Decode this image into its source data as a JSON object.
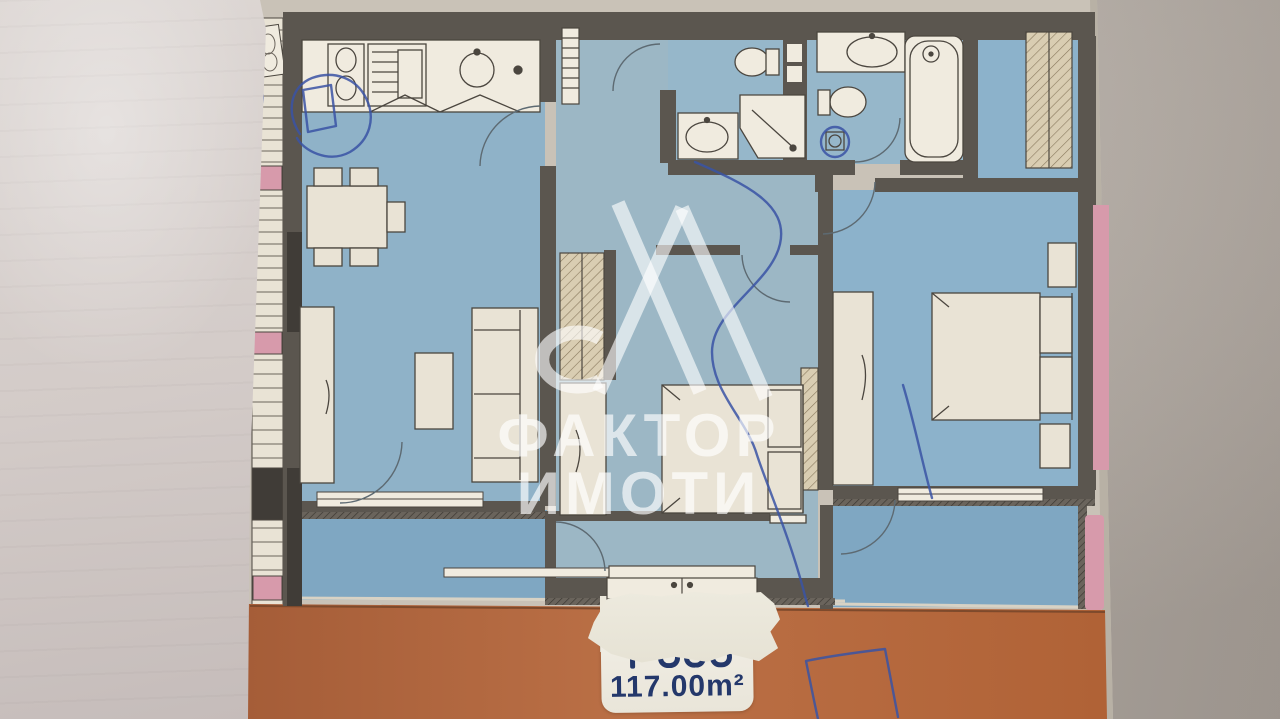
{
  "watermark": {
    "logo_name": "faktor-imoti-logo",
    "line1": "ФАКТОР",
    "line2": "ИМОТИ"
  },
  "area_label": {
    "unit_line_obscured": true,
    "area": "117.00m²"
  },
  "annotations": {
    "pen_color_name": "blue-ballpoint"
  },
  "colors": {
    "bg-light": "#d9d3cc",
    "bg-mid": "#c6bfb7",
    "bg-dark": "#b2a9a1",
    "paper-light": "#ddd7d4",
    "paper-mid": "#d3cbc8",
    "paper-dark": "#c5bcba",
    "sheet": "#c9c2b7",
    "sheet-edge": "#b8b1a5",
    "wall": "#5b564f",
    "wall-dark": "#403c37",
    "wall-mid": "#6e6861",
    "blue-living": "#8fb2c8",
    "blue-hall": "#9cb7c5",
    "blue-bed": "#8cb2cb",
    "blue-bath": "#96b7ca",
    "blue-balcony": "#7fa7c2",
    "cream": "#e9e3d5",
    "white-fix": "#f0ebdf",
    "outline": "#4b463f",
    "terrace-1": "#a55d38",
    "terrace-2": "#bb7046",
    "terrace-3": "#b06236",
    "pink": "#d79aab",
    "hatch-tan": "#d9cdb2",
    "hatch-line": "#8a7a5e",
    "pen": "#3a53a5",
    "label-ink": "#24386b",
    "wm": "rgba(255,255,255,0.62)"
  }
}
